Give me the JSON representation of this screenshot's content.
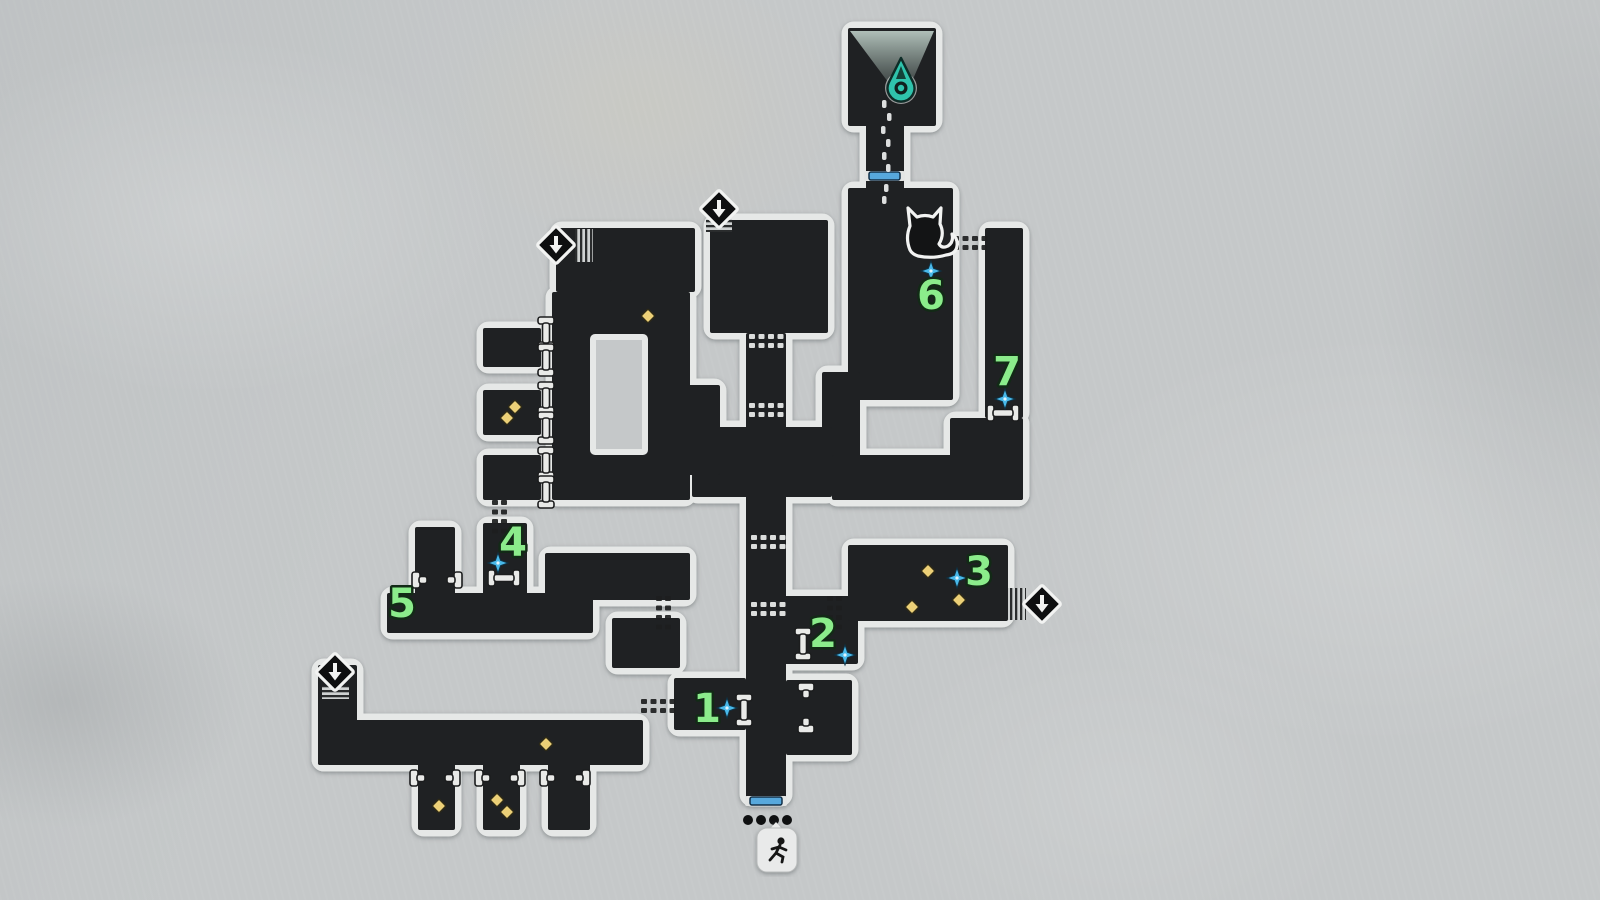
{
  "screen": {
    "name": "area-map",
    "width": 1600,
    "height": 900
  },
  "colors": {
    "bg": "#c5c8c9",
    "room_fill": "#1f2123",
    "room_outline": "#e6e8e7",
    "marker_green": "#8bec8b",
    "sparkle_blue": "#49b9ea",
    "collectible_yellow": "#ecd077",
    "door_blue": "#57a8dc",
    "beacon_teal": "#2fc3ac",
    "icon_black": "#0e0f10",
    "icon_white": "#f2f3f2"
  },
  "map": {
    "rooms": [
      {
        "id": "skylight-room",
        "x": 848,
        "y": 28,
        "w": 88,
        "h": 98
      },
      {
        "id": "skylight-neck",
        "x": 866,
        "y": 122,
        "w": 38,
        "h": 70
      },
      {
        "id": "cat-room",
        "x": 848,
        "y": 188,
        "w": 105,
        "h": 212
      },
      {
        "id": "cat-room-foot",
        "x": 822,
        "y": 372,
        "w": 38,
        "h": 86
      },
      {
        "id": "right-shaft",
        "x": 985,
        "y": 228,
        "w": 38,
        "h": 190
      },
      {
        "id": "right-upper-block",
        "x": 950,
        "y": 418,
        "w": 73,
        "h": 82
      },
      {
        "id": "right-band",
        "x": 832,
        "y": 455,
        "w": 191,
        "h": 45
      },
      {
        "id": "upper-mid-room",
        "x": 710,
        "y": 220,
        "w": 118,
        "h": 113
      },
      {
        "id": "central-corridor",
        "x": 746,
        "y": 333,
        "w": 40,
        "h": 467
      },
      {
        "id": "hub-band",
        "x": 692,
        "y": 427,
        "w": 140,
        "h": 70
      },
      {
        "id": "ring-arm",
        "x": 685,
        "y": 385,
        "w": 35,
        "h": 90
      },
      {
        "id": "upper-left-room",
        "x": 556,
        "y": 228,
        "w": 139,
        "h": 64
      },
      {
        "id": "ring-tab",
        "x": 610,
        "y": 280,
        "w": 47,
        "h": 16
      },
      {
        "id": "ring-room",
        "x": 552,
        "y": 292,
        "w": 138,
        "h": 208
      },
      {
        "id": "left-arm-1",
        "x": 483,
        "y": 328,
        "w": 58,
        "h": 39
      },
      {
        "id": "left-arm-2",
        "x": 483,
        "y": 390,
        "w": 58,
        "h": 45
      },
      {
        "id": "left-arm-3",
        "x": 483,
        "y": 455,
        "w": 58,
        "h": 45
      },
      {
        "id": "stub-a",
        "x": 415,
        "y": 527,
        "w": 40,
        "h": 70
      },
      {
        "id": "stub-4",
        "x": 483,
        "y": 523,
        "w": 44,
        "h": 74
      },
      {
        "id": "room-5",
        "x": 387,
        "y": 593,
        "w": 206,
        "h": 40
      },
      {
        "id": "room-5-band",
        "x": 545,
        "y": 553,
        "w": 145,
        "h": 47
      },
      {
        "id": "mid-small-room",
        "x": 612,
        "y": 618,
        "w": 68,
        "h": 50
      },
      {
        "id": "room-1",
        "x": 674,
        "y": 678,
        "w": 72,
        "h": 52
      },
      {
        "id": "lower-right-stub",
        "x": 786,
        "y": 680,
        "w": 66,
        "h": 75
      },
      {
        "id": "room-2",
        "x": 784,
        "y": 596,
        "w": 74,
        "h": 68
      },
      {
        "id": "room-3",
        "x": 848,
        "y": 545,
        "w": 160,
        "h": 76
      },
      {
        "id": "southwest-exit-stub",
        "x": 318,
        "y": 665,
        "w": 39,
        "h": 100
      },
      {
        "id": "southwest-bar",
        "x": 318,
        "y": 720,
        "w": 325,
        "h": 45
      },
      {
        "id": "sw-stub-1",
        "x": 418,
        "y": 763,
        "w": 37,
        "h": 67
      },
      {
        "id": "sw-stub-2",
        "x": 483,
        "y": 763,
        "w": 37,
        "h": 67
      },
      {
        "id": "sw-stub-3",
        "x": 548,
        "y": 763,
        "w": 42,
        "h": 67
      }
    ],
    "ring_hole": {
      "x": 593,
      "y": 337,
      "w": 52,
      "h": 115
    },
    "markers": [
      {
        "n": "1",
        "lx": 707,
        "ly": 709,
        "sx": 727,
        "sy": 708
      },
      {
        "n": "2",
        "lx": 823,
        "ly": 634,
        "sx": 845,
        "sy": 655
      },
      {
        "n": "3",
        "lx": 979,
        "ly": 572,
        "sx": 957,
        "sy": 578
      },
      {
        "n": "4",
        "lx": 513,
        "ly": 543,
        "sx": 498,
        "sy": 563
      },
      {
        "n": "5",
        "lx": 402,
        "ly": 604,
        "sx": null,
        "sy": null
      },
      {
        "n": "6",
        "lx": 931,
        "ly": 296,
        "sx": 931,
        "sy": 271
      },
      {
        "n": "7",
        "lx": 1007,
        "ly": 372,
        "sx": 1005,
        "sy": 399
      }
    ],
    "collectibles": [
      {
        "x": 648,
        "y": 316
      },
      {
        "x": 515,
        "y": 407
      },
      {
        "x": 507,
        "y": 418
      },
      {
        "x": 928,
        "y": 571
      },
      {
        "x": 912,
        "y": 607
      },
      {
        "x": 959,
        "y": 600
      },
      {
        "x": 546,
        "y": 744
      },
      {
        "x": 439,
        "y": 806
      },
      {
        "x": 497,
        "y": 800
      },
      {
        "x": 507,
        "y": 812
      }
    ],
    "connectors": [
      {
        "t": "bone-v",
        "x": 546,
        "y": 333
      },
      {
        "t": "bone-v",
        "x": 546,
        "y": 360
      },
      {
        "t": "bone-v",
        "x": 546,
        "y": 398
      },
      {
        "t": "bone-v",
        "x": 546,
        "y": 428
      },
      {
        "t": "bone-v",
        "x": 546,
        "y": 463
      },
      {
        "t": "bone-v",
        "x": 546,
        "y": 492
      },
      {
        "t": "bone-v",
        "x": 744,
        "y": 710
      },
      {
        "t": "bone-v",
        "x": 803,
        "y": 644
      },
      {
        "t": "broken-v",
        "x": 806,
        "y": 708
      },
      {
        "t": "bone-h",
        "x": 504,
        "y": 578
      },
      {
        "t": "bone-h",
        "x": 1003,
        "y": 413
      },
      {
        "t": "broken-h",
        "x": 437,
        "y": 580
      },
      {
        "t": "broken-h",
        "x": 435,
        "y": 778
      },
      {
        "t": "broken-h",
        "x": 500,
        "y": 778
      },
      {
        "t": "broken-h",
        "x": 565,
        "y": 778
      }
    ],
    "passages": [
      {
        "o": "h",
        "s": "dark",
        "x": 953,
        "y": 236
      },
      {
        "o": "h",
        "s": "dark",
        "x": 641,
        "y": 699
      },
      {
        "o": "v",
        "s": "dark",
        "x": 492,
        "y": 500
      },
      {
        "o": "v",
        "s": "dark",
        "x": 656,
        "y": 596
      },
      {
        "o": "v",
        "s": "dark",
        "x": 827,
        "y": 596
      },
      {
        "o": "h",
        "s": "light",
        "x": 749,
        "y": 334
      },
      {
        "o": "h",
        "s": "light",
        "x": 749,
        "y": 403
      },
      {
        "o": "h",
        "s": "light",
        "x": 751,
        "y": 535
      },
      {
        "o": "h",
        "s": "light",
        "x": 751,
        "y": 602
      }
    ],
    "exit_icons": [
      {
        "x": 556,
        "y": 245
      },
      {
        "x": 719,
        "y": 209
      },
      {
        "x": 335,
        "y": 672
      },
      {
        "x": 1042,
        "y": 604
      }
    ],
    "hatches": [
      {
        "x": 575,
        "y": 229,
        "w": 18,
        "h": 33,
        "o": "v"
      },
      {
        "x": 706,
        "y": 219,
        "w": 26,
        "h": 13,
        "o": "h"
      },
      {
        "x": 322,
        "y": 686,
        "w": 27,
        "h": 13,
        "o": "h"
      },
      {
        "x": 1008,
        "y": 588,
        "w": 18,
        "h": 32,
        "o": "v"
      }
    ],
    "doors": [
      {
        "x": 869,
        "y": 172,
        "w": 31
      },
      {
        "x": 750,
        "y": 797,
        "w": 32
      }
    ],
    "trail_dots": [
      {
        "x": 884,
        "y": 100
      },
      {
        "x": 889,
        "y": 113
      },
      {
        "x": 883,
        "y": 126
      },
      {
        "x": 888,
        "y": 139
      },
      {
        "x": 884,
        "y": 152
      },
      {
        "x": 888,
        "y": 164
      },
      {
        "x": 886,
        "y": 184
      },
      {
        "x": 884,
        "y": 196
      }
    ],
    "beacon": {
      "x": 901,
      "y": 88
    },
    "cone": {
      "x1": 850,
      "x2": 934,
      "ytop": 31,
      "ax": 903,
      "ay": 102
    },
    "cat": {
      "x": 925,
      "y": 230
    },
    "entrance": {
      "dots": [
        {
          "x": 748,
          "y": 820
        },
        {
          "x": 761,
          "y": 820
        },
        {
          "x": 774,
          "y": 820
        },
        {
          "x": 787,
          "y": 820
        }
      ],
      "badge": {
        "x": 757,
        "y": 828,
        "w": 40,
        "h": 44
      }
    }
  }
}
